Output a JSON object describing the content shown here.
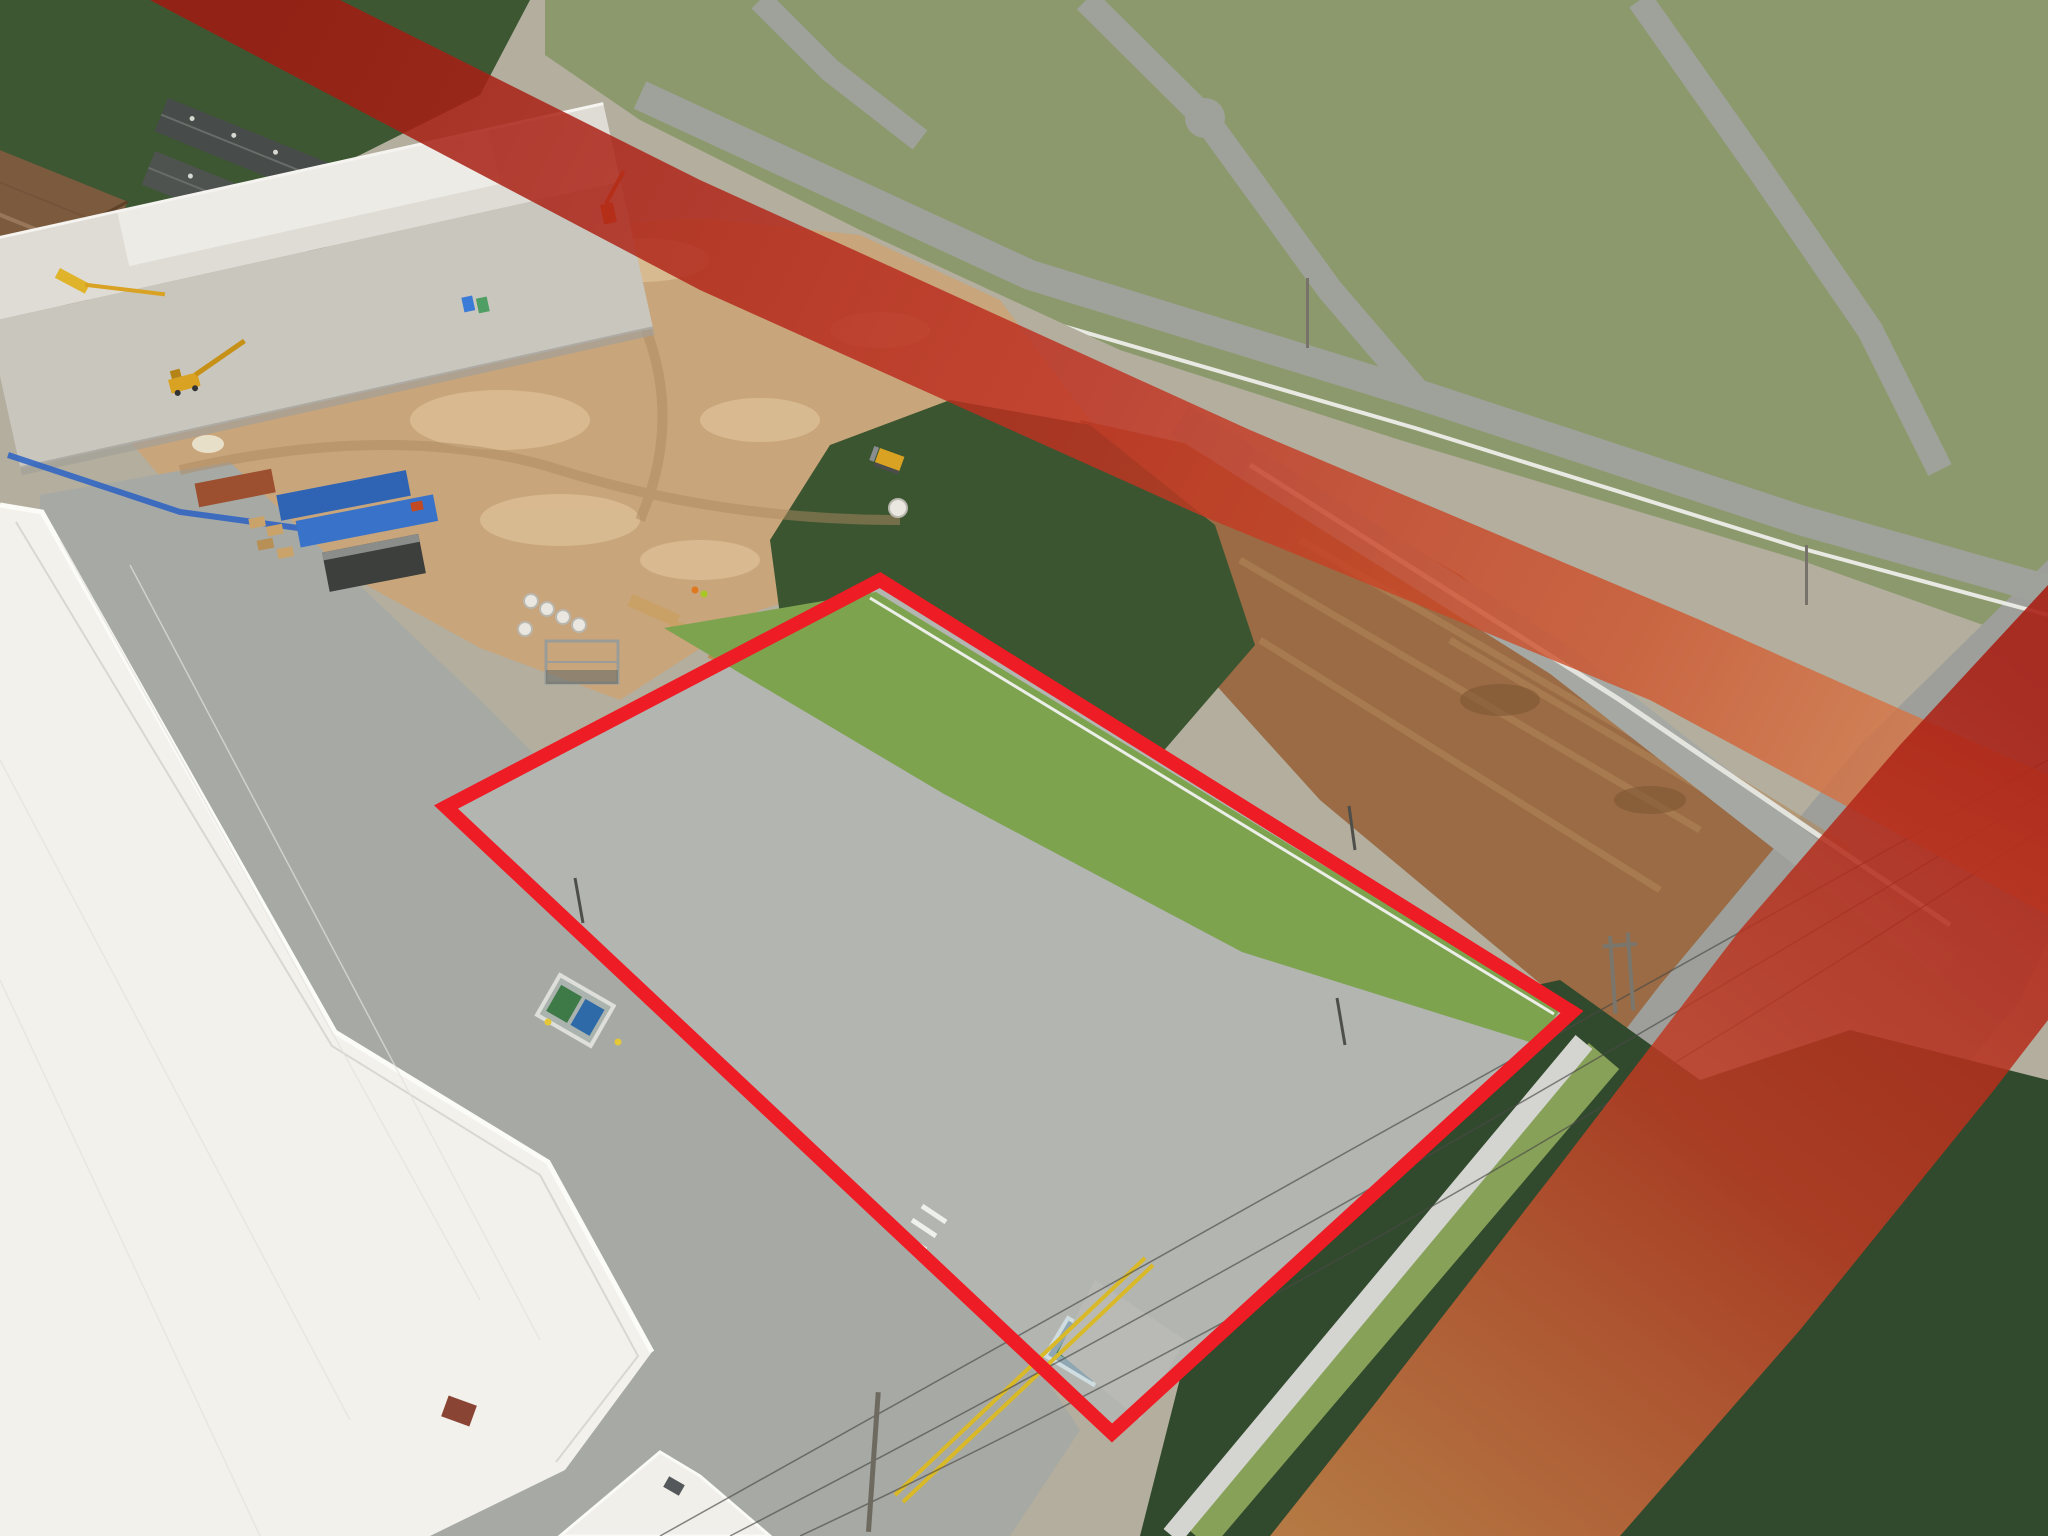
{
  "overlay": {
    "street_label_top": "SW 248TH ST",
    "street_label_right": "SW 129TH AVE",
    "building_parapet_number": "12830",
    "colors": {
      "property_outline": "#ee1c24",
      "band_deep_red": "#a81c12",
      "band_mid_red": "#c23a22",
      "band_orange": "#e2884e",
      "label_text": "#ffffff",
      "label_shadow": "#2a2a30"
    }
  }
}
